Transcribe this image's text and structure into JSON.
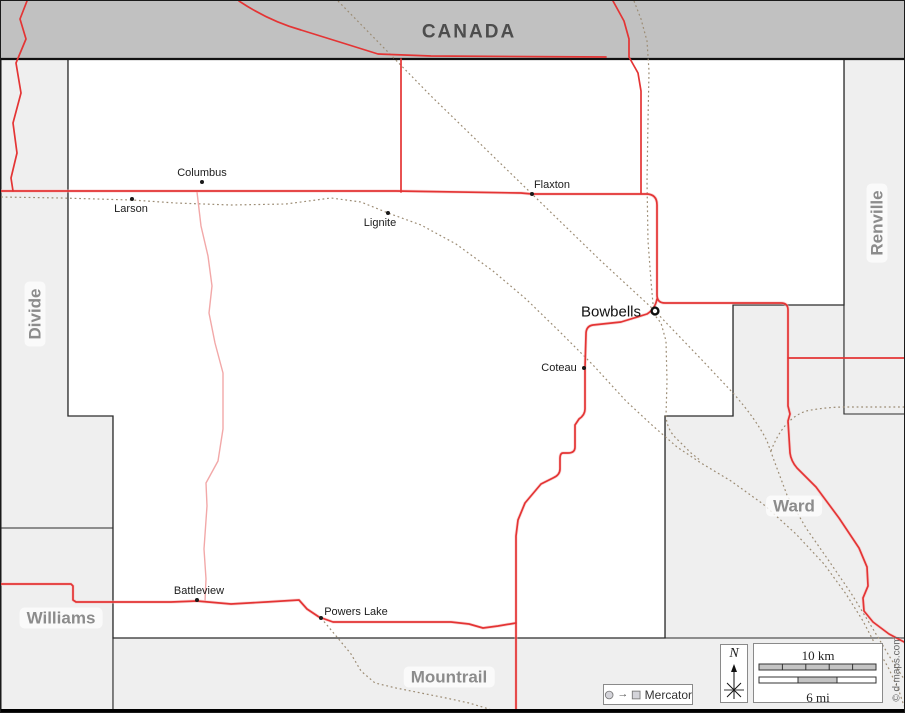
{
  "regions": {
    "canada": {
      "label": "CANADA"
    },
    "divide": {
      "label": "Divide"
    },
    "renville": {
      "label": "Renville"
    },
    "williams": {
      "label": "Williams"
    },
    "mountrail": {
      "label": "Mountrail"
    },
    "ward": {
      "label": "Ward"
    }
  },
  "towns": {
    "columbus": {
      "label": "Columbus"
    },
    "larson": {
      "label": "Larson"
    },
    "lignite": {
      "label": "Lignite"
    },
    "flaxton": {
      "label": "Flaxton"
    },
    "bowbells": {
      "label": "Bowbells",
      "type": "county-seat"
    },
    "coteau": {
      "label": "Coteau"
    },
    "battleview": {
      "label": "Battleview"
    },
    "powers_lake": {
      "label": "Powers Lake"
    }
  },
  "scale": {
    "km": "10 km",
    "mi": "6 mi"
  },
  "north": {
    "label": "N"
  },
  "legend": {
    "projection": "Mercator",
    "arrow": "→"
  },
  "credit": {
    "text": "© d-maps.com"
  },
  "colors": {
    "canada_fill": "#c1c1c1",
    "neighbor_fill": "#efefef",
    "county_fill": "#ffffff",
    "border": "#2b2b2b",
    "road_major": "#e43434",
    "road_minor": "#f2a8a8",
    "railroad": "#9c8c74"
  }
}
